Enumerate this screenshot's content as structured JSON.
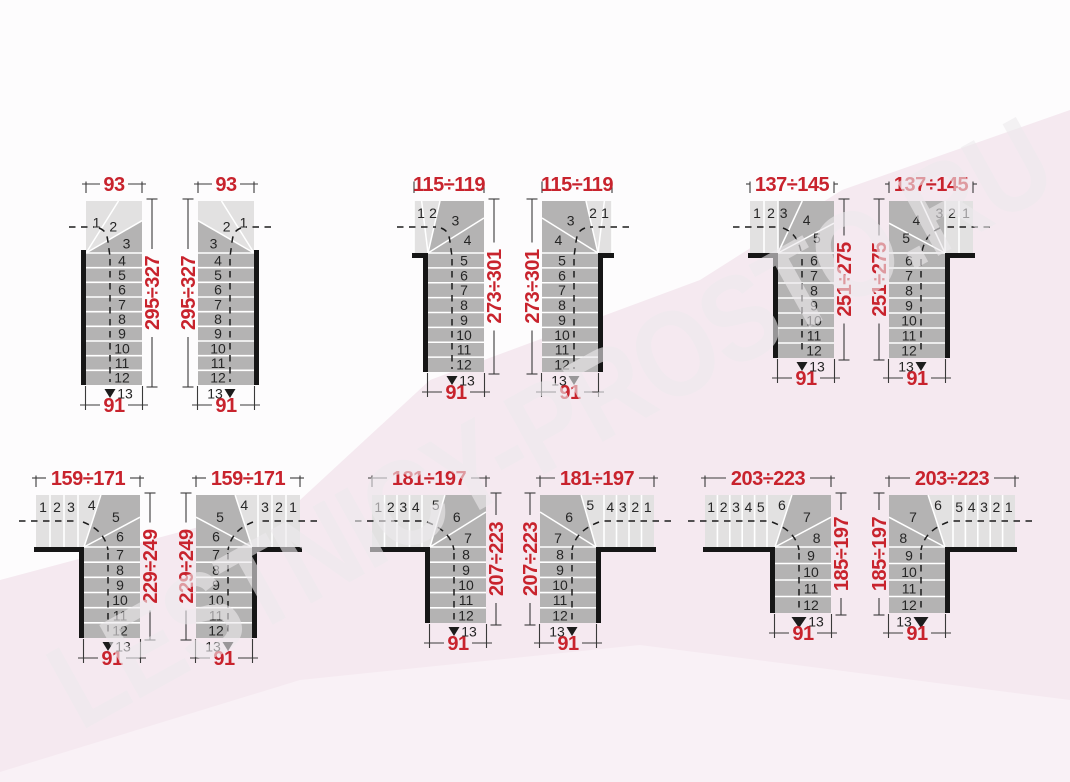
{
  "page": {
    "description": "Catalog sheet of quarter-turn 13-step staircase plan diagrams, dimensions in cm"
  },
  "watermark": {
    "text": "LESTNICY-PROSTO.RU"
  },
  "colors": {
    "accent_red": "#c8232d",
    "tread_dark": "#b4b3b3",
    "tread_light": "#e2e1e1",
    "wall_black": "#161616",
    "separator_white": "#ffffff",
    "line_dark": "#3a3a3a",
    "dash_dark": "#1c1c1c",
    "background_white": "#fdfcfd",
    "background_pink": "#f5e9f0",
    "background_pink_light": "#f9f1f6"
  },
  "diagrams": [
    {
      "id": "plan-1",
      "type": "A",
      "variant": "left",
      "row": 0,
      "x": 86,
      "dim_width": "93",
      "dim_height": "295÷327",
      "dim_depth": "91",
      "steps_entry": [],
      "steps_fan": [
        "1",
        "2",
        "3"
      ],
      "steps_straight": [
        "4",
        "5",
        "6",
        "7",
        "8",
        "9",
        "10",
        "11",
        "12"
      ],
      "step_last": "13"
    },
    {
      "id": "plan-2",
      "type": "A",
      "variant": "right",
      "row": 0,
      "x": 198,
      "dim_width": "93",
      "dim_height": "295÷327",
      "dim_depth": "91",
      "steps_entry": [],
      "steps_fan": [
        "1",
        "2",
        "3"
      ],
      "steps_straight": [
        "4",
        "5",
        "6",
        "7",
        "8",
        "9",
        "10",
        "11",
        "12"
      ],
      "step_last": "13"
    },
    {
      "id": "plan-3",
      "type": "B",
      "variant": "left",
      "row": 0,
      "x": 428,
      "dim_width": "115÷119",
      "dim_height": "273÷301",
      "dim_depth": "91",
      "steps_entry": [],
      "steps_fan": [
        "1",
        "2",
        "3",
        "4"
      ],
      "steps_straight": [
        "5",
        "6",
        "7",
        "8",
        "9",
        "10",
        "11",
        "12"
      ],
      "step_last": "13"
    },
    {
      "id": "plan-4",
      "type": "B",
      "variant": "right",
      "row": 0,
      "x": 542,
      "dim_width": "115÷119",
      "dim_height": "273÷301",
      "dim_depth": "91",
      "steps_entry": [],
      "steps_fan": [
        "1",
        "2",
        "3",
        "4"
      ],
      "steps_straight": [
        "5",
        "6",
        "7",
        "8",
        "9",
        "10",
        "11",
        "12"
      ],
      "step_last": "13"
    },
    {
      "id": "plan-5",
      "type": "C",
      "variant": "left",
      "row": 0,
      "x": 778,
      "dim_width": "137÷145",
      "dim_height": "251÷275",
      "dim_depth": "91",
      "steps_entry": [
        "1",
        "2"
      ],
      "steps_fan": [
        "3",
        "4",
        "5"
      ],
      "steps_straight": [
        "6",
        "7",
        "8",
        "9",
        "10",
        "11",
        "12"
      ],
      "step_last": "13"
    },
    {
      "id": "plan-6",
      "type": "C",
      "variant": "right",
      "row": 0,
      "x": 889,
      "dim_width": "137÷145",
      "dim_height": "251÷275",
      "dim_depth": "91",
      "steps_entry": [
        "1",
        "2"
      ],
      "steps_fan": [
        "3",
        "4",
        "5"
      ],
      "steps_straight": [
        "6",
        "7",
        "8",
        "9",
        "10",
        "11",
        "12"
      ],
      "step_last": "13"
    },
    {
      "id": "plan-7",
      "type": "D",
      "variant": "left",
      "row": 1,
      "x": 84,
      "dim_width": "159÷171",
      "dim_height": "229÷249",
      "dim_depth": "91",
      "steps_entry": [
        "1",
        "2",
        "3"
      ],
      "steps_fan": [
        "4",
        "5",
        "6"
      ],
      "steps_straight": [
        "7",
        "8",
        "9",
        "10",
        "11",
        "12"
      ],
      "step_last": "13"
    },
    {
      "id": "plan-8",
      "type": "D",
      "variant": "right",
      "row": 1,
      "x": 196,
      "dim_width": "159÷171",
      "dim_height": "229÷249",
      "dim_depth": "91",
      "steps_entry": [
        "1",
        "2",
        "3"
      ],
      "steps_fan": [
        "4",
        "5",
        "6"
      ],
      "steps_straight": [
        "7",
        "8",
        "9",
        "10",
        "11",
        "12"
      ],
      "step_last": "13"
    },
    {
      "id": "plan-9",
      "type": "E",
      "variant": "left",
      "row": 1,
      "x": 430,
      "dim_width": "181÷197",
      "dim_height": "207÷223",
      "dim_depth": "91",
      "steps_entry": [
        "1",
        "2",
        "3",
        "4"
      ],
      "steps_fan": [
        "5",
        "6",
        "7"
      ],
      "steps_straight": [
        "8",
        "9",
        "10",
        "11",
        "12"
      ],
      "step_last": "13"
    },
    {
      "id": "plan-10",
      "type": "E",
      "variant": "right",
      "row": 1,
      "x": 540,
      "dim_width": "181÷197",
      "dim_height": "207÷223",
      "dim_depth": "91",
      "steps_entry": [
        "1",
        "2",
        "3",
        "4"
      ],
      "steps_fan": [
        "5",
        "6",
        "7"
      ],
      "steps_straight": [
        "8",
        "9",
        "10",
        "11",
        "12"
      ],
      "step_last": "13"
    },
    {
      "id": "plan-11",
      "type": "F",
      "variant": "left",
      "row": 1,
      "x": 775,
      "dim_width": "203÷223",
      "dim_height": "185÷197",
      "dim_depth": "91",
      "steps_entry": [
        "1",
        "2",
        "3",
        "4",
        "5"
      ],
      "steps_fan": [
        "6",
        "7",
        "8"
      ],
      "steps_straight": [
        "9",
        "10",
        "11",
        "12"
      ],
      "step_last": "13"
    },
    {
      "id": "plan-12",
      "type": "F",
      "variant": "right",
      "row": 1,
      "x": 889,
      "dim_width": "203÷223",
      "dim_height": "185÷197",
      "dim_depth": "91",
      "steps_entry": [
        "1",
        "2",
        "3",
        "4",
        "5"
      ],
      "steps_fan": [
        "6",
        "7",
        "8"
      ],
      "steps_straight": [
        "9",
        "10",
        "11",
        "12"
      ],
      "step_last": "13"
    }
  ]
}
